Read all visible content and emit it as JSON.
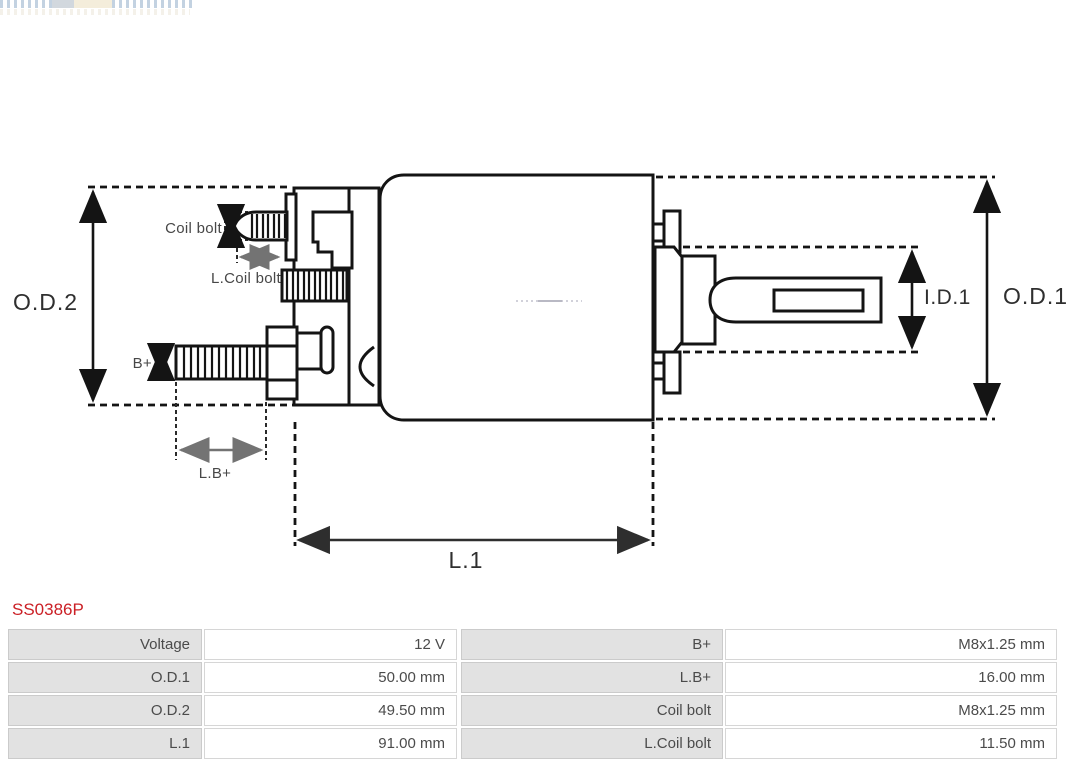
{
  "part": {
    "number": "SS0386P",
    "number_color": "#cb2026"
  },
  "diagram": {
    "stroke_color": "#141414",
    "labels": {
      "od2": "O.D.2",
      "od1": "O.D.1",
      "id1": "I.D.1",
      "l1": "L.1",
      "coil_bolt": "Coil bolt",
      "l_coil_bolt": "L.Coil bolt",
      "b_plus": "B+",
      "l_b_plus": "L.B+"
    }
  },
  "specs": {
    "rows": [
      {
        "label": "Voltage",
        "value": "12 V",
        "label2": "B+",
        "value2": "M8x1.25 mm"
      },
      {
        "label": "O.D.1",
        "value": "50.00 mm",
        "label2": "L.B+",
        "value2": "16.00 mm"
      },
      {
        "label": "O.D.2",
        "value": "49.50 mm",
        "label2": "Coil bolt",
        "value2": "M8x1.25 mm"
      },
      {
        "label": "L.1",
        "value": "91.00 mm",
        "label2": "L.Coil bolt",
        "value2": "11.50 mm"
      }
    ]
  }
}
